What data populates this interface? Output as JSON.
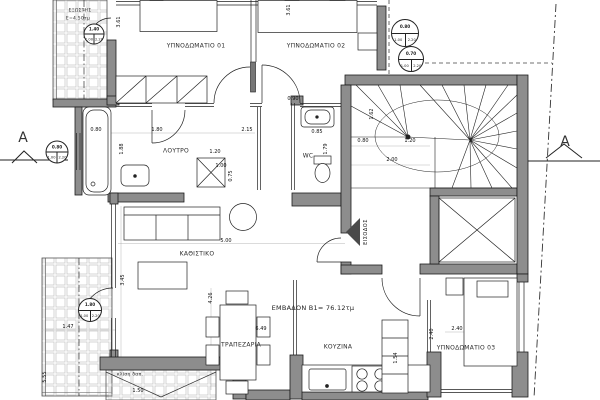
{
  "colors": {
    "wall_fill": "#8d8d8d",
    "line": "#1c1c1c",
    "paper": "#ffffff",
    "tile_line": "#c9c9c9",
    "leaf_fill": "#4a4a4a"
  },
  "rooms": [
    {
      "label": "ΥΠΝΟΔΩΜΑΤΙΟ 01",
      "x": 196,
      "y": 46
    },
    {
      "label": "ΥΠΝΟΔΩΜΑΤΙΟ 02",
      "x": 316,
      "y": 46
    },
    {
      "label": "ΛΟΥΤΡΟ",
      "x": 176,
      "y": 151
    },
    {
      "label": "WC",
      "x": 308,
      "y": 156
    },
    {
      "label": "ΚΑΘΙΣΤΙΚΟ",
      "x": 197,
      "y": 254
    },
    {
      "label": "ΤΡΑΠΕΖΑΡΙΑ",
      "x": 241,
      "y": 345
    },
    {
      "label": "ΚΟΥΖΙΝΑ",
      "x": 338,
      "y": 347
    },
    {
      "label": "ΥΠΝΟΔΩΜΑΤΙΟ 03",
      "x": 466,
      "y": 348
    }
  ],
  "area_label": {
    "text": "ΕΜΒΑΔΟΝ Β1= 76.12τμ",
    "x": 313,
    "y": 308
  },
  "balcony_top": {
    "name": "ΕΞΩΣΤΗΣ",
    "area": "Ε=4.50τμ",
    "x": 80,
    "y": 11
  },
  "entrance": {
    "label": "ΕΙΣΟΔΟΣ",
    "x": 366,
    "y": 232
  },
  "slope_note": {
    "label": "κλίση δαπ.",
    "x": 130,
    "y": 375
  },
  "section_markers": [
    {
      "label": "A",
      "x": 23,
      "y": 138
    },
    {
      "label": "A",
      "x": 565,
      "y": 142
    }
  ],
  "dimensions": [
    {
      "text": "3.61",
      "x": 119,
      "y": 22,
      "rot": -90
    },
    {
      "text": "3.61",
      "x": 289,
      "y": 10,
      "rot": -90
    },
    {
      "text": "0.90",
      "x": 293,
      "y": 99,
      "rot": 0
    },
    {
      "text": "0.80",
      "x": 96,
      "y": 130,
      "rot": 0
    },
    {
      "text": "1.80",
      "x": 157,
      "y": 130,
      "rot": 0
    },
    {
      "text": "2.15",
      "x": 247,
      "y": 130,
      "rot": 0
    },
    {
      "text": "1.88",
      "x": 122,
      "y": 149,
      "rot": -90
    },
    {
      "text": "1.20",
      "x": 215,
      "y": 152,
      "rot": 0
    },
    {
      "text": "1.00",
      "x": 221,
      "y": 166,
      "rot": 0
    },
    {
      "text": "0.75",
      "x": 231,
      "y": 176,
      "rot": -90
    },
    {
      "text": "0.85",
      "x": 317,
      "y": 132,
      "rot": 0
    },
    {
      "text": "1.79",
      "x": 326,
      "y": 149,
      "rot": -90
    },
    {
      "text": "1.62",
      "x": 372,
      "y": 114,
      "rot": -90
    },
    {
      "text": "0.80",
      "x": 363,
      "y": 141,
      "rot": 0
    },
    {
      "text": "1.20",
      "x": 410,
      "y": 141,
      "rot": 0
    },
    {
      "text": "2.00",
      "x": 392,
      "y": 160,
      "rot": 0
    },
    {
      "text": "3.45",
      "x": 123,
      "y": 280,
      "rot": -90
    },
    {
      "text": "4.26",
      "x": 211,
      "y": 298,
      "rot": -90
    },
    {
      "text": "5.00",
      "x": 226,
      "y": 241,
      "rot": 0
    },
    {
      "text": "6.49",
      "x": 261,
      "y": 329,
      "rot": 0
    },
    {
      "text": "1.47",
      "x": 68,
      "y": 327,
      "rot": 0
    },
    {
      "text": "5.55",
      "x": 45,
      "y": 377,
      "rot": -90
    },
    {
      "text": "1.50",
      "x": 138,
      "y": 391,
      "rot": 0
    },
    {
      "text": "1.54",
      "x": 396,
      "y": 358,
      "rot": -90
    },
    {
      "text": "2.40",
      "x": 457,
      "y": 329,
      "rot": 0
    },
    {
      "text": "2.40",
      "x": 432,
      "y": 334,
      "rot": -90
    }
  ],
  "door_tags": [
    {
      "x": 94,
      "y": 34,
      "d": 19,
      "size": "1.40",
      "sill": "1.00",
      "height": "2.20"
    },
    {
      "x": 405,
      "y": 33,
      "d": 26,
      "size": "0.80",
      "sill": "1.00",
      "height": "2.20"
    },
    {
      "x": 411,
      "y": 59,
      "d": 24,
      "size": "0.70",
      "sill": "1.00",
      "height": "2.20"
    },
    {
      "x": 57,
      "y": 152,
      "d": 21,
      "size": "0.80",
      "sill": "1.00",
      "height": "2.20"
    },
    {
      "x": 90,
      "y": 310,
      "d": 22,
      "size": "1.80",
      "sill": "1.00",
      "height": "2.20"
    }
  ]
}
